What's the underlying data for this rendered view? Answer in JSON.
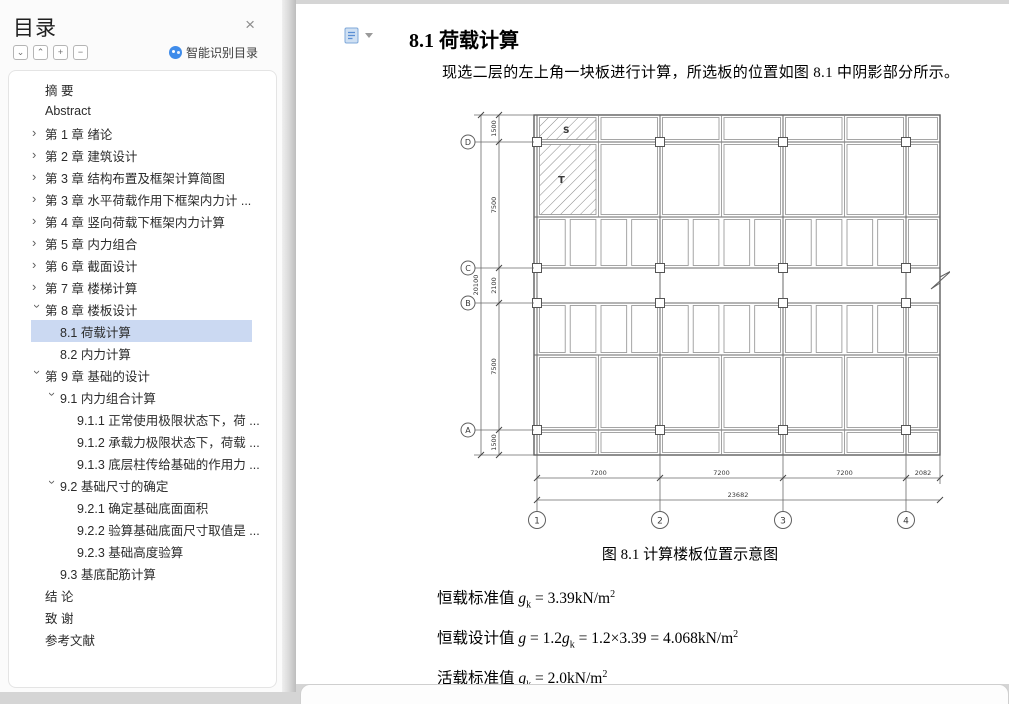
{
  "sidebar": {
    "title": "目录",
    "close_glyph": "×",
    "buttons": [
      {
        "name": "expand-all-button",
        "glyph": "⌄"
      },
      {
        "name": "collapse-all-button",
        "glyph": "⌃"
      },
      {
        "name": "plus-button",
        "glyph": "+"
      },
      {
        "name": "minus-button",
        "glyph": "−"
      }
    ],
    "smart_toc_label": "智能识别目录",
    "items": [
      {
        "label": "摘  要",
        "level": 0,
        "chevron": null,
        "selected": false
      },
      {
        "label": "Abstract",
        "level": 0,
        "chevron": null,
        "selected": false
      },
      {
        "label": "第 1 章  绪论",
        "level": 0,
        "chevron": "collapsed",
        "selected": false
      },
      {
        "label": "第 2 章  建筑设计",
        "level": 0,
        "chevron": "collapsed",
        "selected": false
      },
      {
        "label": "第 3 章  结构布置及框架计算简图",
        "level": 0,
        "chevron": "collapsed",
        "selected": false
      },
      {
        "label": "第 3 章  水平荷载作用下框架内力计 ...",
        "level": 0,
        "chevron": "collapsed",
        "selected": false
      },
      {
        "label": "第 4 章  竖向荷载下框架内力计算",
        "level": 0,
        "chevron": "collapsed",
        "selected": false
      },
      {
        "label": "第 5 章  内力组合",
        "level": 0,
        "chevron": "collapsed",
        "selected": false
      },
      {
        "label": "第 6 章  截面设计",
        "level": 0,
        "chevron": "collapsed",
        "selected": false
      },
      {
        "label": "第 7 章  楼梯计算",
        "level": 0,
        "chevron": "collapsed",
        "selected": false
      },
      {
        "label": "第 8 章  楼板设计",
        "level": 0,
        "chevron": "expanded",
        "selected": false
      },
      {
        "label": "8.1 荷载计算",
        "level": 1,
        "chevron": null,
        "selected": true
      },
      {
        "label": "8.2 内力计算",
        "level": 1,
        "chevron": null,
        "selected": false
      },
      {
        "label": "第 9 章  基础的设计",
        "level": 0,
        "chevron": "expanded",
        "selected": false
      },
      {
        "label": "9.1 内力组合计算",
        "level": 1,
        "chevron": "expanded",
        "selected": false
      },
      {
        "label": "9.1.1 正常使用极限状态下，荷 ...",
        "level": 2,
        "chevron": null,
        "selected": false
      },
      {
        "label": "9.1.2 承载力极限状态下，荷载 ...",
        "level": 2,
        "chevron": null,
        "selected": false
      },
      {
        "label": "9.1.3 底层柱传给基础的作用力 ...",
        "level": 2,
        "chevron": null,
        "selected": false
      },
      {
        "label": "9.2 基础尺寸的确定",
        "level": 1,
        "chevron": "expanded",
        "selected": false
      },
      {
        "label": "9.2.1 确定基础底面面积",
        "level": 2,
        "chevron": null,
        "selected": false
      },
      {
        "label": "9.2.2 验算基础底面尺寸取值是 ...",
        "level": 2,
        "chevron": null,
        "selected": false
      },
      {
        "label": "9.2.3 基础高度验算",
        "level": 2,
        "chevron": null,
        "selected": false
      },
      {
        "label": "9.3 基底配筋计算",
        "level": 1,
        "chevron": null,
        "selected": false
      },
      {
        "label": "结  论",
        "level": 0,
        "chevron": null,
        "selected": false
      },
      {
        "label": "致  谢",
        "level": 0,
        "chevron": null,
        "selected": false
      },
      {
        "label": "参考文献",
        "level": 0,
        "chevron": null,
        "selected": false
      }
    ],
    "colors": {
      "selected_bg": "#cbd9f2",
      "ai_icon": "#3f8cea"
    }
  },
  "document": {
    "heading": "8.1 荷载计算",
    "paragraph": "现选二层的左上角一块板进行计算，所选板的位置如图 8.1 中阴影部分所示。",
    "figure": {
      "caption": "图 8.1 计算楼板位置示意图",
      "slab_labels": {
        "s": "S",
        "t": "T"
      },
      "row_labels": [
        "D",
        "C",
        "B",
        "A"
      ],
      "col_labels": [
        "1",
        "2",
        "3",
        "4"
      ],
      "dims_left": [
        "1500",
        "7500",
        "2100",
        "7500",
        "1500"
      ],
      "dim_left_total": "20100",
      "dims_bottom": [
        "7200",
        "7200",
        "7200",
        "2082"
      ],
      "dim_bottom_total": "23682"
    },
    "formulas": [
      {
        "label": "恒载标准值 ",
        "expr": [
          [
            "var",
            "g"
          ],
          [
            "sub",
            "k"
          ],
          [
            "txt",
            " = 3.39kN/m"
          ],
          [
            "sup",
            "2"
          ]
        ]
      },
      {
        "label": "恒载设计值 ",
        "expr": [
          [
            "var",
            "g"
          ],
          [
            "txt",
            " = 1.2"
          ],
          [
            "var",
            "g"
          ],
          [
            "sub",
            "k"
          ],
          [
            "txt",
            " = 1.2×3.39 = 4.068kN/m"
          ],
          [
            "sup",
            "2"
          ]
        ]
      },
      {
        "label": "活载标准值 ",
        "expr": [
          [
            "var",
            "q"
          ],
          [
            "sub",
            "k"
          ],
          [
            "txt",
            " = 2.0kN/m"
          ],
          [
            "sup",
            "2"
          ]
        ]
      }
    ]
  }
}
